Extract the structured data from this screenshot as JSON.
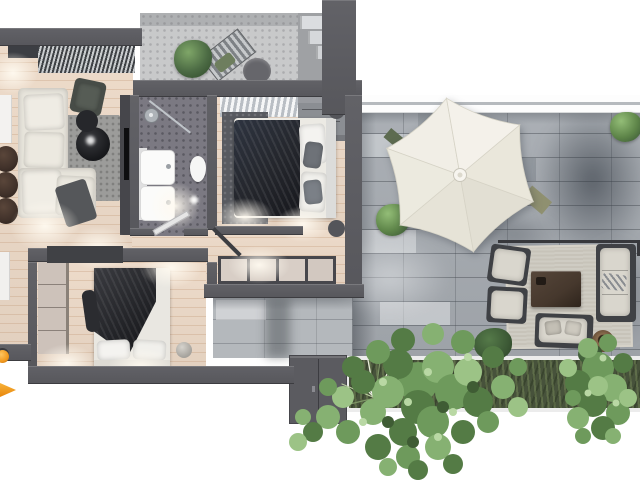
{
  "title": "3d-apartment-floor-plan-with-terrace-render",
  "canvas": {
    "width": 640,
    "height": 480
  },
  "scene": {
    "type": "top-down 3D architectural render, no visible text",
    "rooms": [
      "living-room-kitchen",
      "balcony",
      "bathroom",
      "bedroom-1",
      "hallway",
      "bedroom-2",
      "terrace",
      "garden-bed"
    ],
    "objects": {
      "living_room": [
        "kitchen-counter",
        "window-blinds",
        "wall-shelf",
        "sectional-sofa",
        "throw-blanket",
        "area-rug",
        "round-coffee-tables",
        "armchair",
        "leather-poufs",
        "tv-wall"
      ],
      "balcony": [
        "mosaic-floor",
        "potted-plant",
        "lounge-chair",
        "round-table",
        "steps"
      ],
      "bathroom": [
        "double-vanity",
        "shower-head",
        "glass-partition",
        "toilet",
        "door"
      ],
      "bedroom_1": [
        "curtains",
        "closet-shelves",
        "double-bed",
        "dark-duvet",
        "pillows",
        "round-nightstands",
        "rug",
        "sideboard",
        "door"
      ],
      "bedroom_2": [
        "wardrobe",
        "double-bed",
        "dark-throw",
        "pillows",
        "floor-ball"
      ],
      "terrace": [
        "white-railing",
        "stone-paving",
        "hexagonal-parasol",
        "dining-benches",
        "boxwood-bushes",
        "lounge-rug",
        "outdoor-armchairs",
        "outdoor-coffee-table",
        "outdoor-sofa",
        "outdoor-loveseat",
        "rattan-pot",
        "glass-rail-line",
        "storage-cabinet"
      ],
      "garden_bed": [
        "planter-frame",
        "ornamental-grass",
        "shrubs",
        "large-tree",
        "small-tree"
      ],
      "misc": [
        "orange-marker-triangle",
        "orange-lamp"
      ]
    }
  },
  "colors": {
    "wall": "#57575c",
    "wall_hi": "#626267",
    "wood": "#ecd9c7",
    "paving": "#a6abb1",
    "paving_light": "#b4b8bc",
    "balcony_tile": "#c8c9ca",
    "bath_floor": "#7b7982",
    "railing_line": "#b6babe",
    "planter_green": "#47523b",
    "planter_frame": "#ececec",
    "cabinet": "#5b5b60",
    "umbrella": "#f0ede5",
    "umbrella_seam": "#d6d3c6",
    "sofa_cream": "#e7e4db",
    "rug_gray": "#9c9c9a",
    "blanket_dark": "#24262c",
    "marble_table": "#17181b",
    "pouf_brown": "#40312a",
    "outdoor_frame": "#3f4145",
    "outdoor_cushion": "#d9d6cd",
    "outdoor_table": "#46382d",
    "rug_beige": "#c7c3b9",
    "tree_green": "#6e9a5c",
    "tree_dark": "#4a6b3d",
    "tree_light": "#8fb878",
    "accent_orange": "#f2991e"
  }
}
